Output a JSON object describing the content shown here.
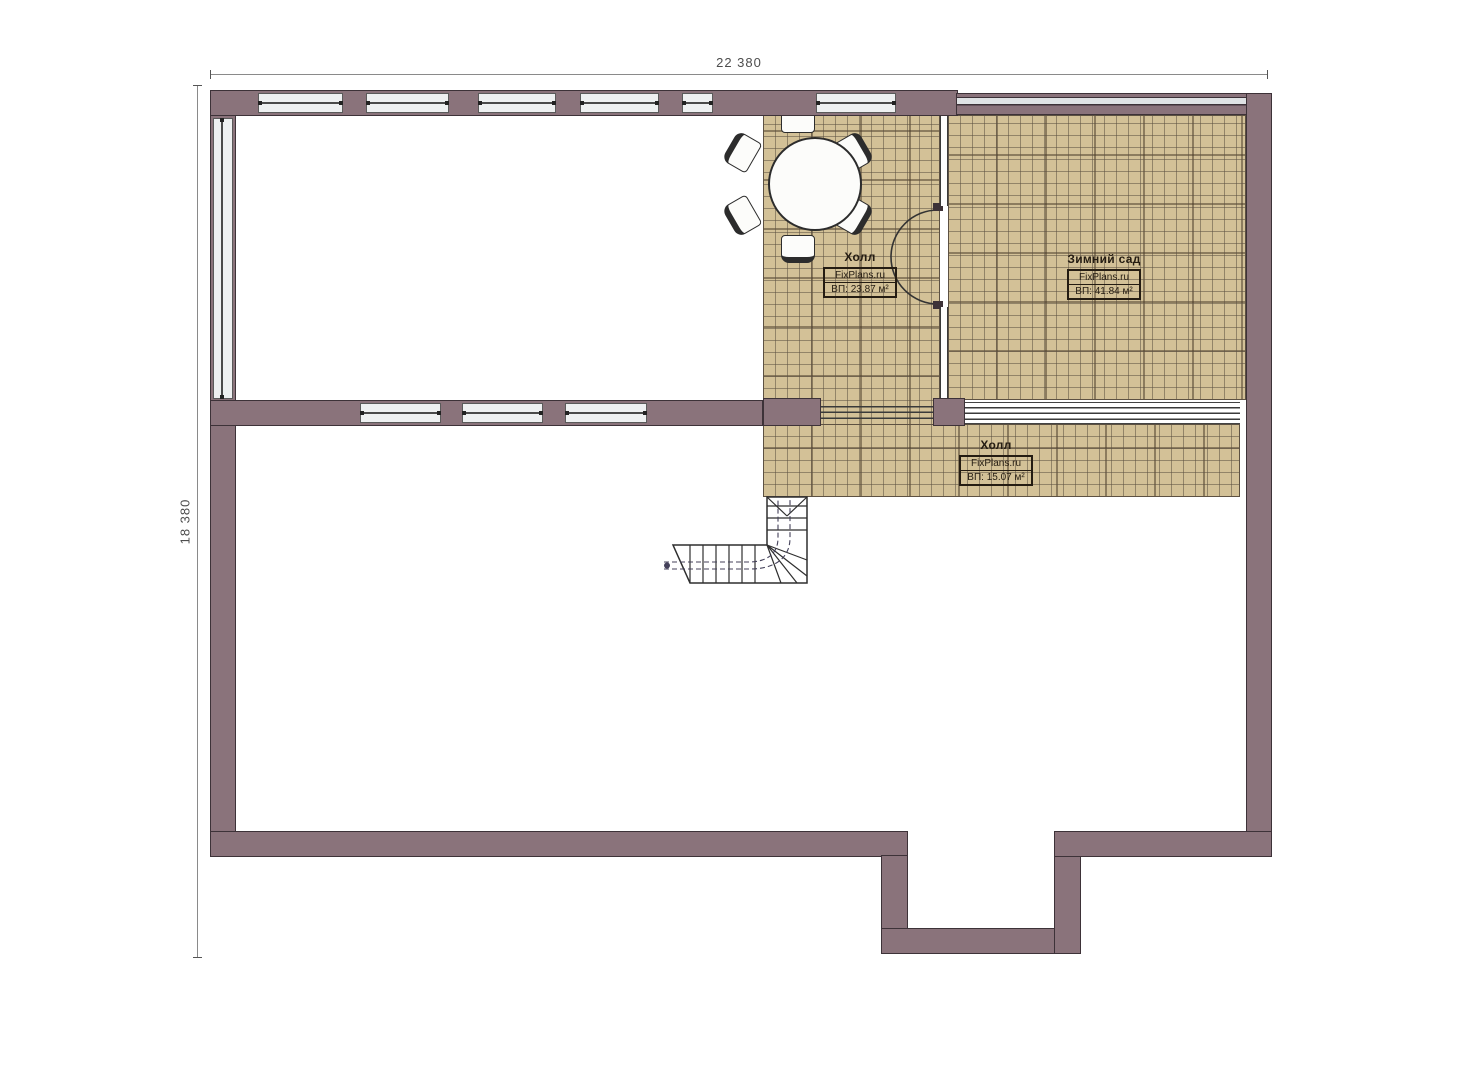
{
  "plan": {
    "type": "floor-plan",
    "floor": "attic"
  },
  "dimensions": {
    "top": "22 380",
    "left": "18 380"
  },
  "rooms": {
    "hall_upper": {
      "name": "Холл",
      "brand": "FixPlans.ru",
      "area": "ВП: 23.87 м²"
    },
    "winter_garden": {
      "name": "Зимний сад",
      "brand": "FixPlans.ru",
      "area": "ВП: 41.84 м²"
    },
    "hall_lower": {
      "name": "Холл",
      "brand": "FixPlans.ru",
      "area": "ВП: 15.07 м²"
    }
  },
  "colors": {
    "wall": "#8a737b",
    "wall_outline": "#3d3238",
    "tile": "#d3c197",
    "tile_line": "#8a7a5c",
    "window_fill": "#eef0f1",
    "window_line": "#5a5a5a",
    "dim_line": "#8a8a8a",
    "dim_text": "#4d4d4d",
    "label_text": "#241c12"
  }
}
